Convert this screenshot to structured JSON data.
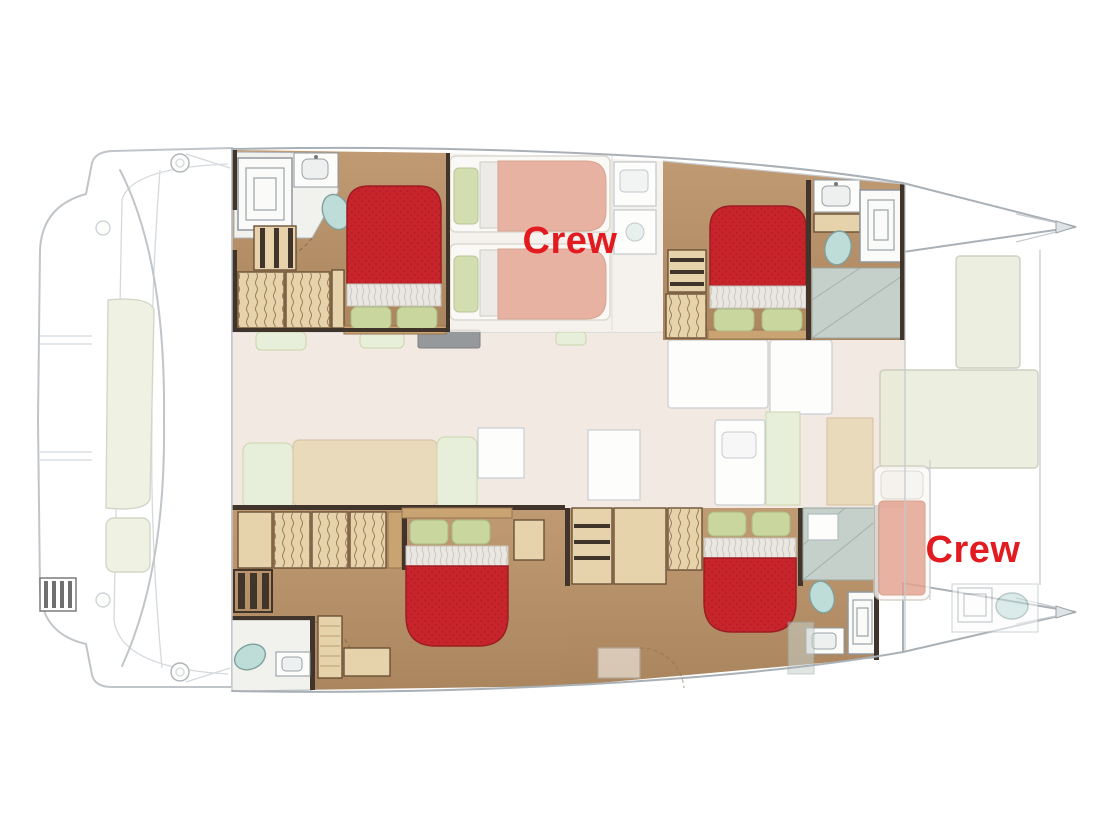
{
  "labels": {
    "crew_midship": "Crew",
    "crew_bow": "Crew"
  },
  "colors": {
    "label_red": "#e21b21",
    "bed_red": "#c7242c",
    "bed_red_dark": "#a81c23",
    "sheet_white": "#eae7e2",
    "pillow_green": "#c9d79e",
    "wood_floor": "#b58f68",
    "wood_mid": "#caa372",
    "wood_light": "#e6d3ac",
    "partition_dark": "#40342b",
    "toilet_teal": "#bedcd8",
    "pad_green": "#e9ecd8",
    "mattress_salmon": "#e4a28e",
    "hull_line": "#a9b0b6",
    "hull_line_soft": "#c6cbd0",
    "salon_floor": "#ece1d8",
    "salon_wood": "#e2cda3",
    "sofa_green": "#dfe8cc",
    "wet_gray": "#c6d0ca"
  }
}
